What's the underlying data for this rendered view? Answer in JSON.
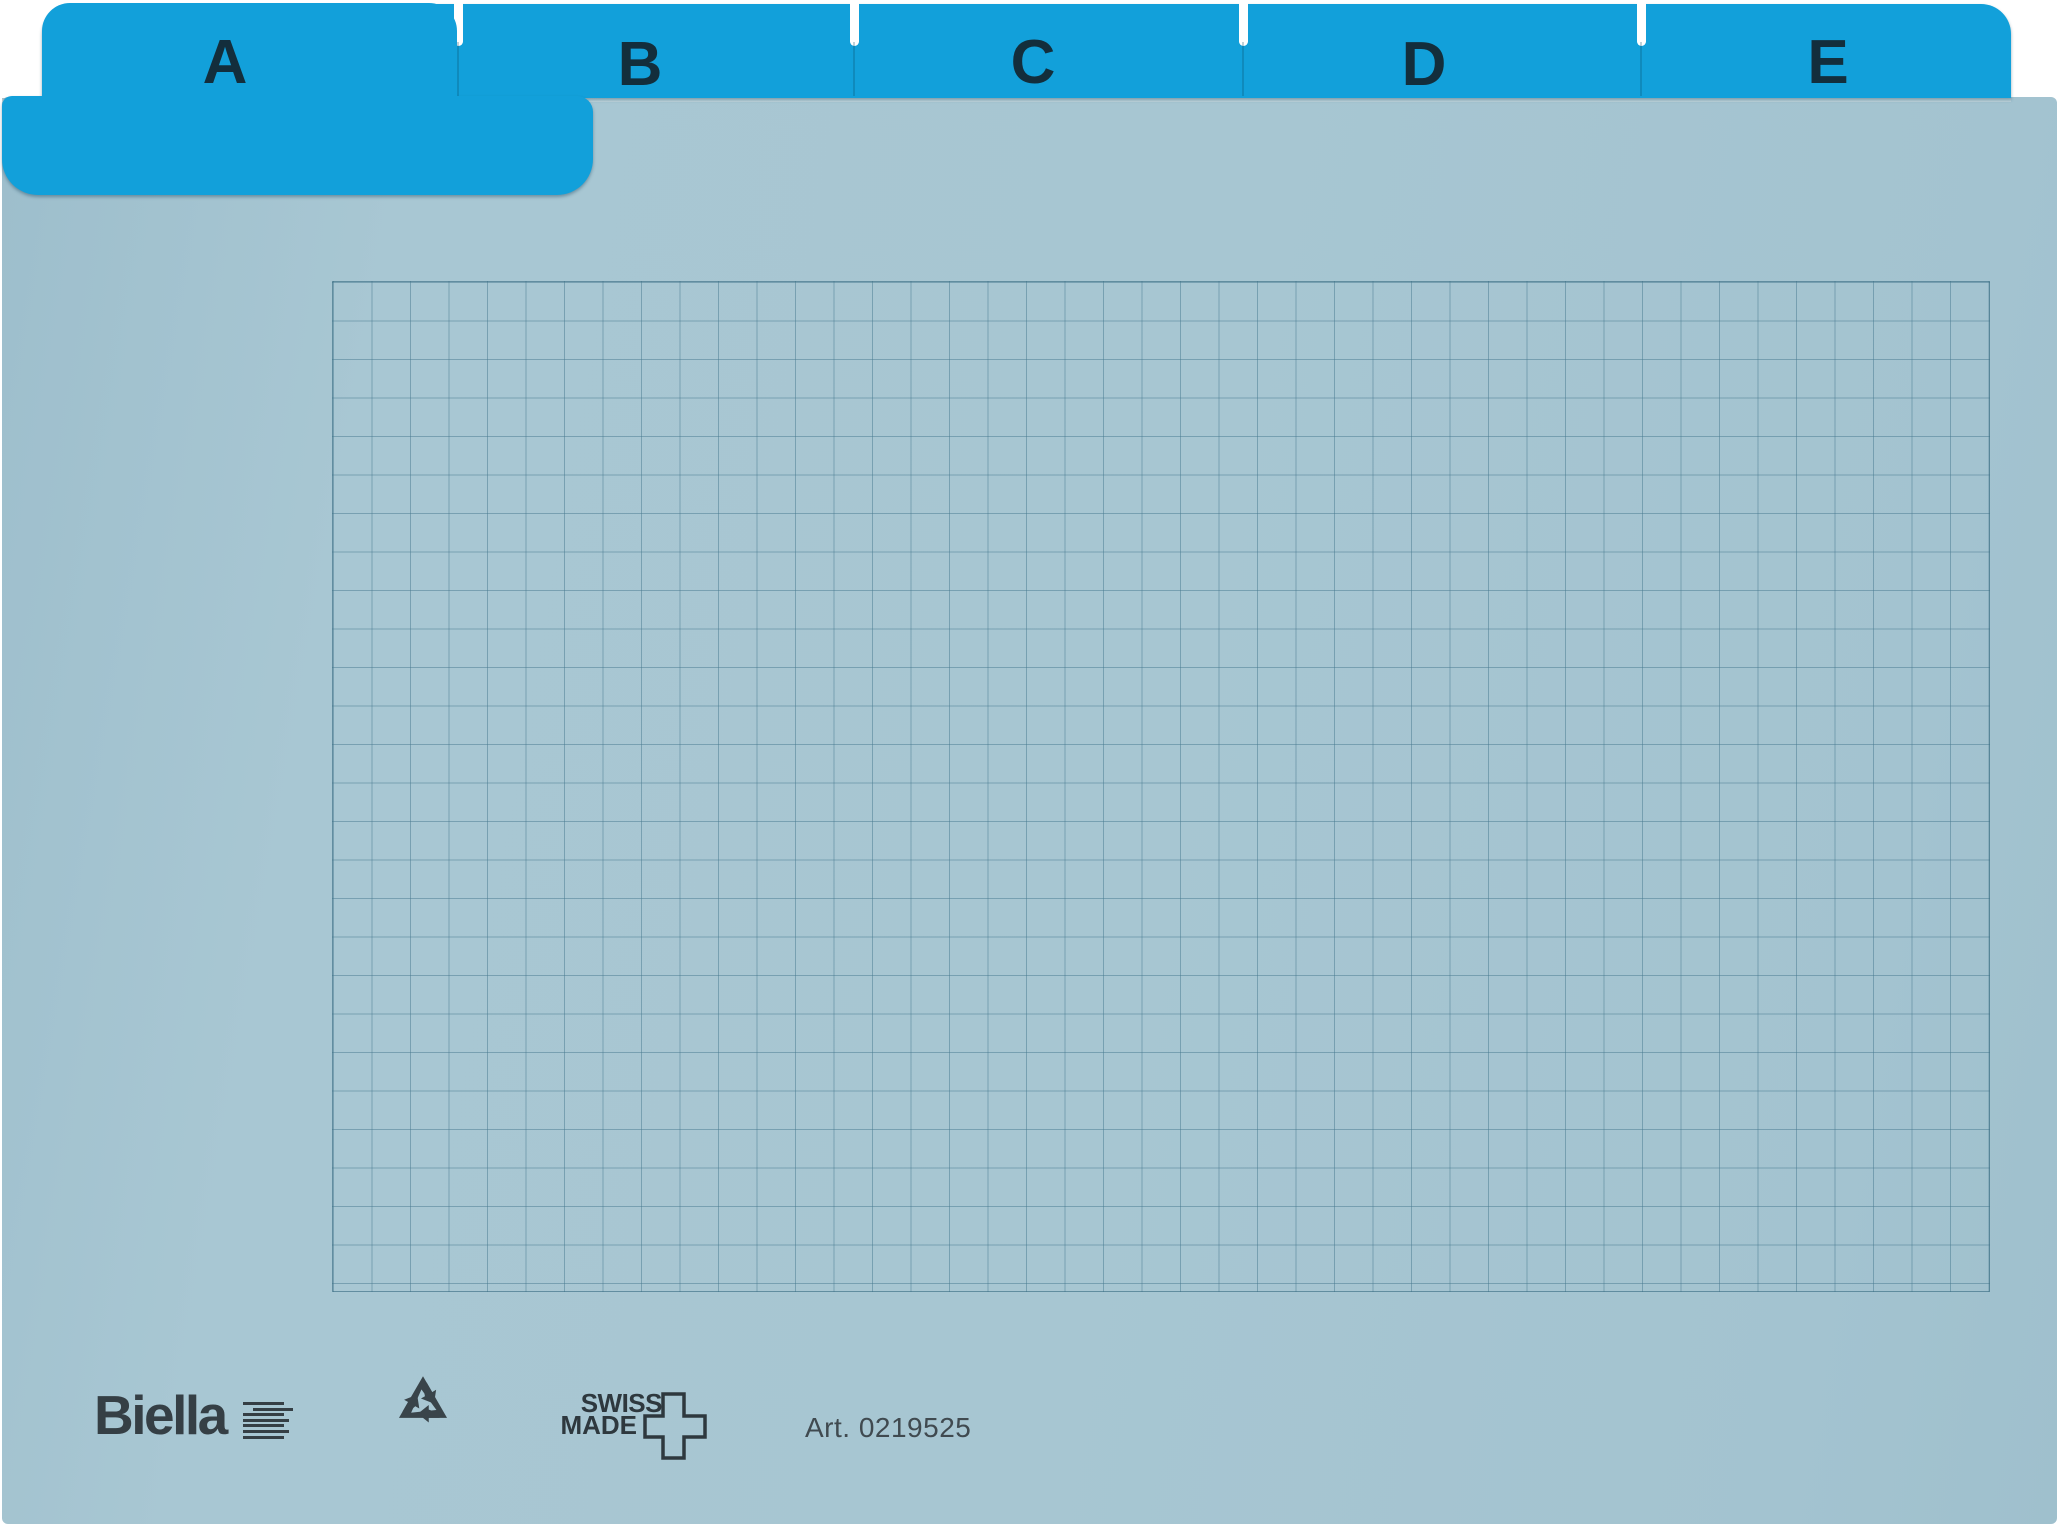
{
  "product": {
    "kind": "A-Z index card divider set, blue, squared ruling",
    "front_tab": "A"
  },
  "tabs": [
    {
      "label": "A"
    },
    {
      "label": "B"
    },
    {
      "label": "C"
    },
    {
      "label": "D"
    },
    {
      "label": "E"
    }
  ],
  "footer": {
    "brand": "Biella",
    "swiss_made_line1": "SWISS",
    "swiss_made_line2": "MADE",
    "article": "Art. 0219525"
  },
  "icons": {
    "recycle": "recycle-icon",
    "swiss_cross": "swiss-cross-icon",
    "brand_lines": "biella-lines-icon"
  },
  "colors": {
    "tab_blue": "#12a0da",
    "card_blue": "#a7c6d2",
    "grid_line": "#7fa6b5",
    "letter_ink": "#132e3c",
    "logo_ink": "#353f45",
    "background": "#ffffff"
  }
}
